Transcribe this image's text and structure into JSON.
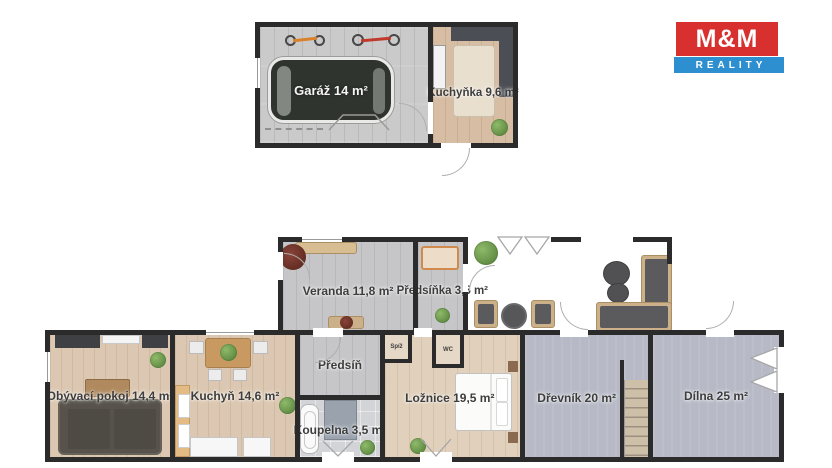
{
  "logo": {
    "top": "M&M",
    "bottom": "REALITY"
  },
  "rooms": {
    "garaz": "Garáž 14 m²",
    "kuchynka": "Kuchyňka 9,6 m²",
    "veranda": "Veranda 11,8 m²",
    "predsinka": "Předsíňka 3,5 m²",
    "obyvaci": "Obývací pokoj 14,4 m²",
    "kuchyn": "Kuchyň 14,6 m²",
    "predsin": "Předsíň",
    "koupelna": "Koupelna 3,5 m²",
    "spiz": "Spíž",
    "wc": "WC",
    "loznice": "Ložnice 19,5 m²",
    "drevnik": "Dřevník 20 m²",
    "dilna": "Dílna 25 m²"
  },
  "colors": {
    "wall": "#2b2b2b",
    "logo_red": "#d8302e",
    "logo_blue": "#2e8fd0",
    "floor_wood_light": "#dcc8b2",
    "floor_wood_gray": "#c6c6c8",
    "floor_concrete": "#b7bac6",
    "label_text": "#3d3d3d"
  }
}
